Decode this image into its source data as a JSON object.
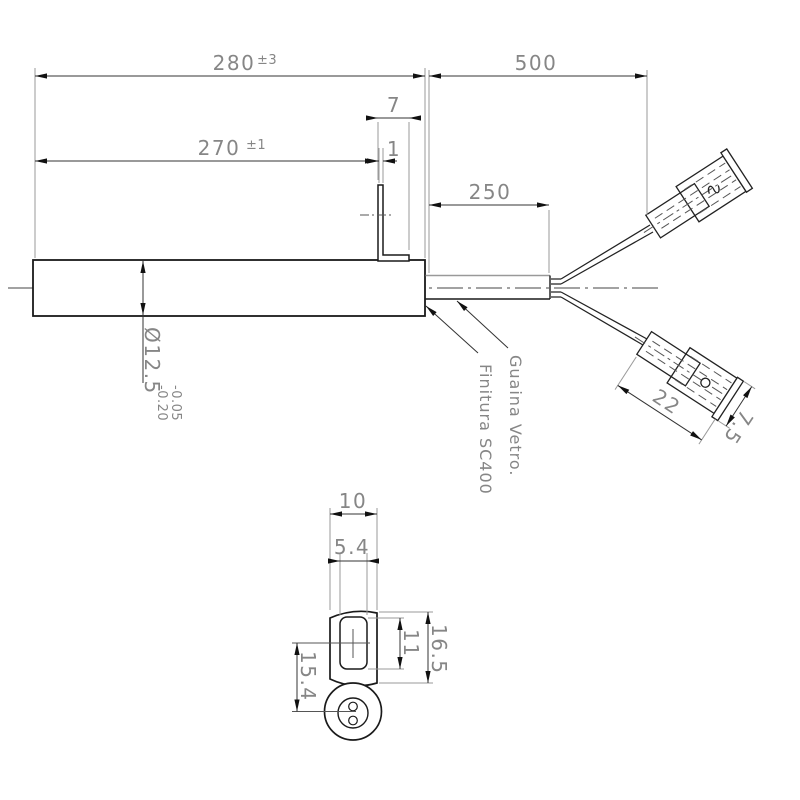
{
  "drawing": {
    "title_implied": "Cartridge heater technical drawing",
    "colors": {
      "object_line": "#1a1a1a",
      "dimension_line": "#333333",
      "extension_line": "#9a9a9a",
      "text": "#868686",
      "background": "#ffffff"
    },
    "dims": {
      "d280": {
        "value": "280",
        "tol": "±3"
      },
      "d500": {
        "value": "500"
      },
      "d270": {
        "value": "270",
        "tol": "±1"
      },
      "d7": {
        "value": "7"
      },
      "d1": {
        "value": "1"
      },
      "d250": {
        "value": "250"
      },
      "d12_5": {
        "value": "Ø12.5",
        "tol_upper": "-0.05",
        "tol_lower": "-0.20"
      },
      "d22": {
        "value": "22"
      },
      "d7_5": {
        "value": "7.5"
      },
      "d10": {
        "value": "10"
      },
      "d5_4": {
        "value": "5.4"
      },
      "d11": {
        "value": "11"
      },
      "d16_5": {
        "value": "16.5"
      },
      "d15_4": {
        "value": "15.4"
      }
    },
    "labels": {
      "finish": "Finitura SC400",
      "sheath": "Guaina Vetro."
    }
  }
}
